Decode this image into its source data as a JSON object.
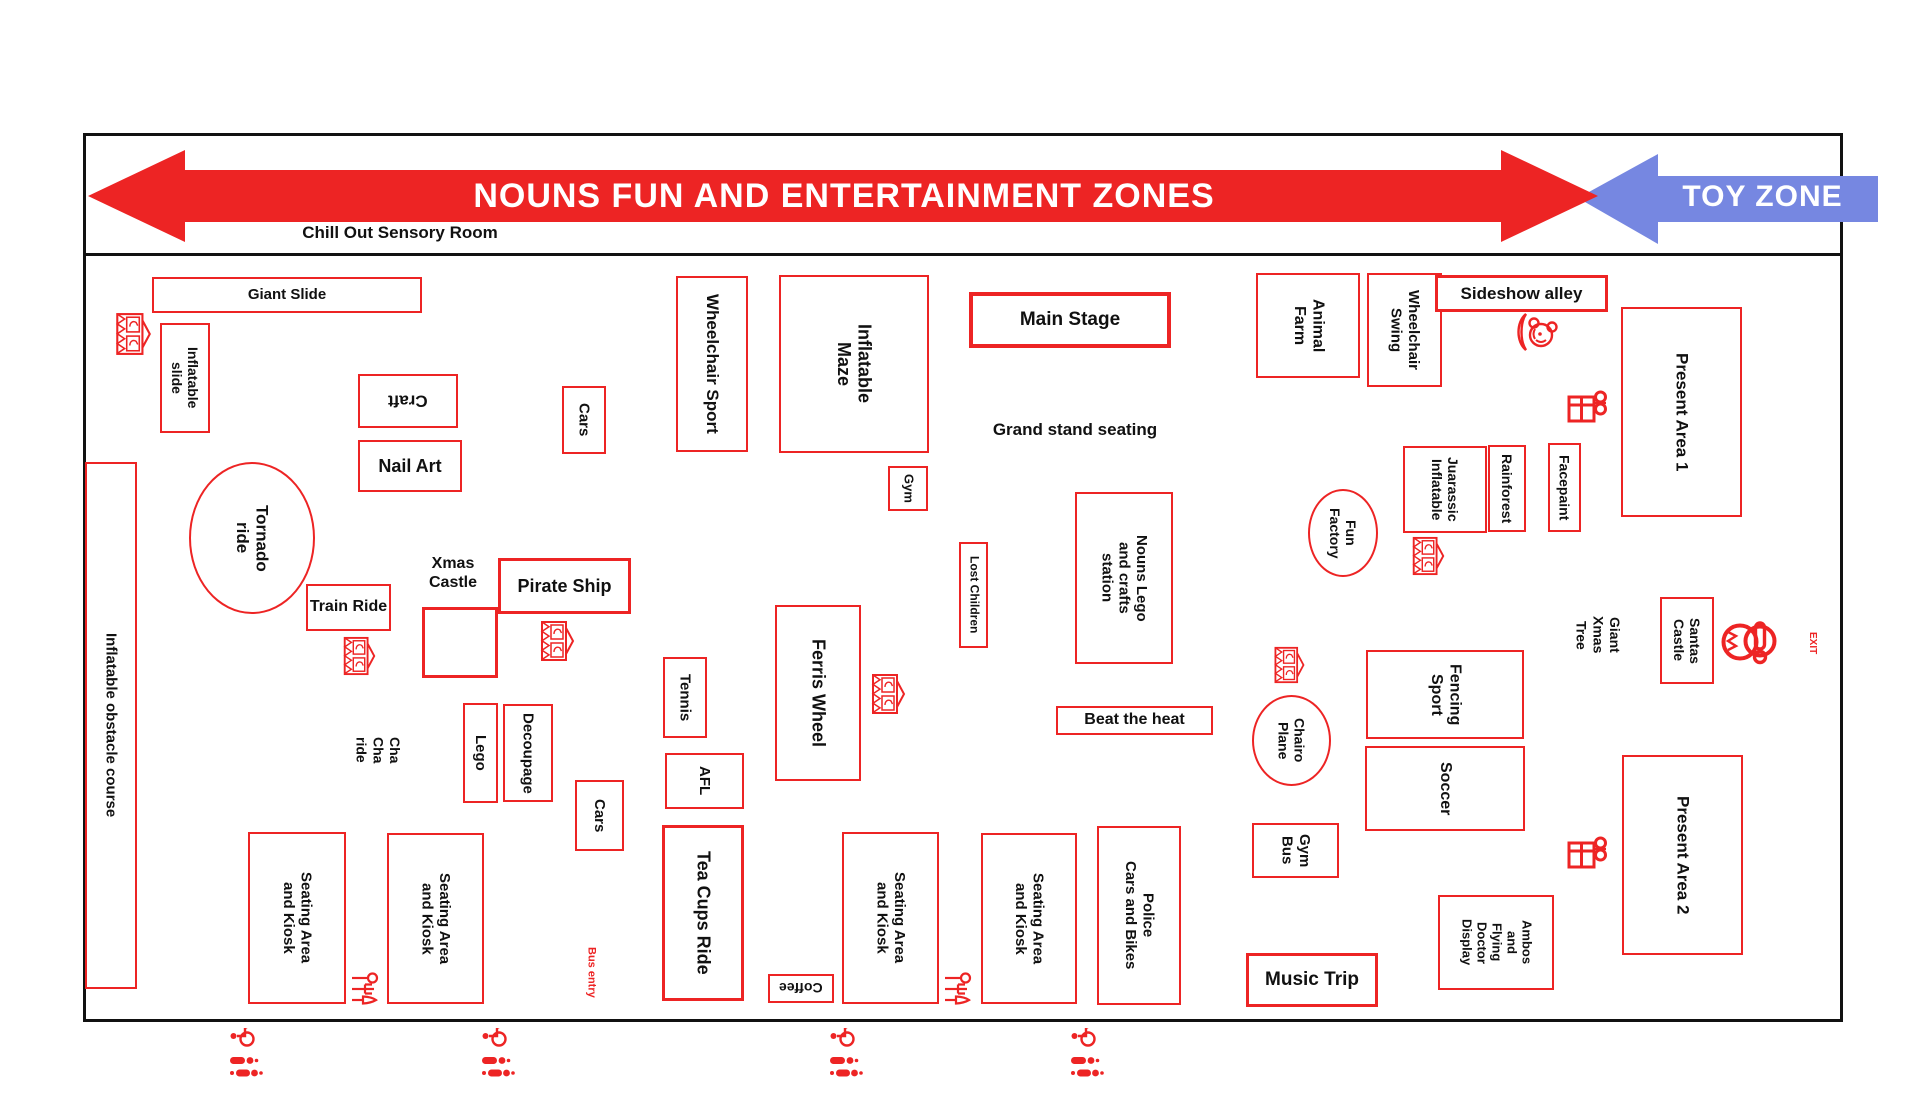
{
  "banner": {
    "main_label": "NOUNS FUN AND ENTERTAINMENT ZONES",
    "toy_label": "TOY ZONE",
    "sensory_label": "Chill Out Sensory Room"
  },
  "colors": {
    "red": "#ed2424",
    "blue": "#7687e1",
    "ink": "#111111"
  },
  "areas": {
    "giant_slide": "Giant Slide",
    "inflatable_slide": "Inflatable\nslide",
    "inflatable_obstacle_course": "Inflatable obstacle course",
    "craft": "Craft",
    "nail_art": "Nail Art",
    "cars_top": "Cars",
    "wheelchair_sport": "Wheelchair Sport",
    "inflatable_maze": "Inflatable\nMaze",
    "gym": "Gym",
    "main_stage": "Main Stage",
    "grand_stand_seating": "Grand stand seating",
    "animal_farm": "Animal\nFarm",
    "wheelchair_swing": "Wheelchair\nSwing",
    "sideshow_alley": "Sideshow alley",
    "present_area_1": "Present Area 1",
    "juarassic_inflatable": "Juarassic\nInflatable",
    "rainforest": "Rainforest",
    "facepaint": "Facepaint",
    "fun_factory": "Fun\nFactory",
    "tornado_ride": "Tornado\nride",
    "train_ride": "Train Ride",
    "xmas_castle": "Xmas\nCastle",
    "pirate_ship": "Pirate Ship",
    "cha_cha_ride": "Cha\nCha\nride",
    "lego": "Lego",
    "decoupage": "Decoupage",
    "cars_bottom": "Cars",
    "tennis": "Tennis",
    "afl": "AFL",
    "tea_cups_ride": "Tea Cups Ride",
    "ferris_wheel": "Ferris Wheel",
    "lost_children": "Lost Children",
    "nouns_lego_station": "Nouns Lego\nand crafts\nstation",
    "beat_the_heat": "Beat the heat",
    "seating_kiosk": "Seating Area\nand Kiosk",
    "coffee": "Coffee",
    "police_cars_bikes": "Police\nCars and Bikes",
    "chairo_plane": "Chairo\nPlane",
    "fencing_sport": "Fencing\nSport",
    "soccer": "Soccer",
    "giant_xmas_tree": "Giant\nXmas\nTree",
    "santas_castle": "Santas\nCastle",
    "exit": "EXIT",
    "gym_bus": "Gym\nBus",
    "music_trip": "Music Trip",
    "ambos_display": "Ambos\nand\nFlying\nDoctor\nDisplay",
    "present_area_2": "Present Area 2",
    "bus_entry": "Bus entry"
  },
  "icons": [
    "carousel-icon",
    "clown-icon",
    "present-icon",
    "santa-icon",
    "kiosk-cutlery-icon",
    "accessible-toilet-icon"
  ]
}
